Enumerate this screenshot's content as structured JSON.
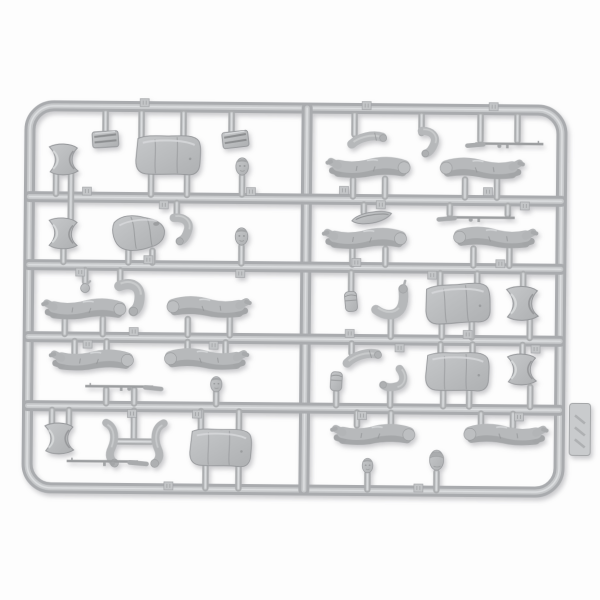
{
  "scene": {
    "type": "plastic-model-sprue-photo",
    "subject": "gray injection-molded sprue with soldier figure parts (torsos, legs, arms, heads, caps, rifles)",
    "rotation_deg": 0.5
  },
  "colors": {
    "background": "#fdfdfd",
    "rail_layers": [
      "#a9abae",
      "#c7c9cb",
      "#dcdee0"
    ],
    "stem_layers": [
      "#abadaf",
      "#c6c8ca",
      "#dadcde"
    ],
    "plastic_base": "#b6b8ba",
    "plastic_shadow": "#95979a",
    "plastic_highlight": "#d8dadc"
  },
  "sprue": {
    "frame": {
      "x1": 28.5,
      "y1": 108,
      "x2": 560.5,
      "y2": 490,
      "rx": 24
    },
    "center_rail_x": 305.5,
    "rails_y": [
      199,
      267,
      339,
      408
    ],
    "tab": {
      "x": 581,
      "y": 427
    }
  },
  "stems": [
    [
      104,
      114,
      134
    ],
    [
      140,
      114,
      140
    ],
    [
      182,
      114,
      140
    ],
    [
      230,
      114,
      133
    ],
    [
      55,
      176,
      196
    ],
    [
      70,
      176,
      223
    ],
    [
      150,
      175,
      196
    ],
    [
      186,
      175,
      196
    ],
    [
      241,
      177,
      195
    ],
    [
      63,
      250,
      264
    ],
    [
      128,
      252,
      264
    ],
    [
      152,
      252,
      264
    ],
    [
      176,
      204,
      219
    ],
    [
      241,
      247,
      264
    ],
    [
      85,
      272,
      284
    ],
    [
      120,
      272,
      286
    ],
    [
      65,
      322,
      336
    ],
    [
      103,
      320,
      336
    ],
    [
      188,
      320,
      336
    ],
    [
      230,
      317,
      336
    ],
    [
      75,
      343,
      355
    ],
    [
      107,
      343,
      357
    ],
    [
      188,
      343,
      353
    ],
    [
      226,
      343,
      353
    ],
    [
      107,
      391,
      405
    ],
    [
      135,
      391,
      405
    ],
    [
      217,
      393,
      405
    ],
    [
      53,
      412,
      428
    ],
    [
      70,
      412,
      428
    ],
    [
      135,
      412,
      440
    ],
    [
      202,
      412,
      433
    ],
    [
      240,
      412,
      433
    ],
    [
      207,
      466,
      489
    ],
    [
      240,
      466,
      489
    ],
    [
      353,
      114,
      134
    ],
    [
      420,
      114,
      132
    ],
    [
      479,
      114,
      139
    ],
    [
      516,
      114,
      139
    ],
    [
      352,
      179,
      196
    ],
    [
      384,
      178,
      196
    ],
    [
      464,
      178,
      196
    ],
    [
      496,
      178,
      196
    ],
    [
      363,
      204,
      212
    ],
    [
      449,
      204,
      213
    ],
    [
      507,
      204,
      213
    ],
    [
      352,
      249,
      264
    ],
    [
      385,
      248,
      264
    ],
    [
      473,
      247,
      264
    ],
    [
      509,
      247,
      264
    ],
    [
      351,
      272,
      291
    ],
    [
      391,
      317,
      336
    ],
    [
      440,
      272,
      286
    ],
    [
      477,
      272,
      286
    ],
    [
      442,
      321,
      336
    ],
    [
      472,
      321,
      336
    ],
    [
      523,
      272,
      288
    ],
    [
      530,
      318,
      336
    ],
    [
      352,
      343,
      353
    ],
    [
      337,
      392,
      405
    ],
    [
      391,
      390,
      405
    ],
    [
      441,
      343,
      354
    ],
    [
      473,
      343,
      354
    ],
    [
      444,
      390,
      405
    ],
    [
      470,
      390,
      405
    ],
    [
      523,
      343,
      352
    ],
    [
      531,
      385,
      405
    ],
    [
      358,
      412,
      425
    ],
    [
      392,
      412,
      427
    ],
    [
      482,
      412,
      425
    ],
    [
      514,
      412,
      425
    ],
    [
      369,
      473,
      489
    ],
    [
      438,
      471,
      489
    ]
  ],
  "hbars": [
    [
      118,
      152,
      443
    ]
  ],
  "tags": [
    [
      143,
      104
    ],
    [
      365,
      105
    ],
    [
      492,
      105
    ],
    [
      86,
      193
    ],
    [
      163,
      206
    ],
    [
      250,
      192
    ],
    [
      343,
      190
    ],
    [
      380,
      204
    ],
    [
      487,
      190
    ],
    [
      524,
      204
    ],
    [
      80,
      274
    ],
    [
      148,
      261
    ],
    [
      240,
      274
    ],
    [
      356,
      262
    ],
    [
      432,
      274
    ],
    [
      500,
      262
    ],
    [
      88,
      346
    ],
    [
      134,
      333
    ],
    [
      214,
      346
    ],
    [
      350,
      333
    ],
    [
      400,
      347
    ],
    [
      468,
      333
    ],
    [
      536,
      347
    ],
    [
      133,
      415
    ],
    [
      198,
      415
    ],
    [
      363,
      415
    ],
    [
      520,
      415
    ],
    [
      170,
      487
    ],
    [
      420,
      487
    ]
  ],
  "parts": [
    {
      "t": "folded",
      "x": 104,
      "y": 141,
      "r": -4,
      "f": 1,
      "s": 1
    },
    {
      "t": "torso",
      "x": 167,
      "y": 157,
      "r": 2,
      "f": 1,
      "s": 1
    },
    {
      "t": "folded",
      "x": 234,
      "y": 140,
      "r": -7,
      "f": 1,
      "s": 1
    },
    {
      "t": "skirt",
      "x": 63,
      "y": 162,
      "r": 0,
      "f": 1,
      "s": 1
    },
    {
      "t": "head",
      "x": 241,
      "y": 167,
      "r": 0,
      "f": 1,
      "s": 1
    },
    {
      "t": "skirt",
      "x": 63,
      "y": 236,
      "r": 2,
      "f": 1,
      "s": 1
    },
    {
      "t": "torso-bent",
      "x": 139,
      "y": 234,
      "r": -3,
      "f": 1,
      "s": 1
    },
    {
      "t": "arm-bent",
      "x": 180,
      "y": 228,
      "r": 15,
      "f": 1,
      "s": 1
    },
    {
      "t": "head",
      "x": 241,
      "y": 237,
      "r": 0,
      "f": 1,
      "s": 1
    },
    {
      "t": "hand",
      "x": 85,
      "y": 290,
      "r": 0,
      "f": 1,
      "s": 1
    },
    {
      "t": "arm-bent",
      "x": 130,
      "y": 296,
      "r": 0,
      "f": 1,
      "s": 1.2
    },
    {
      "t": "legs",
      "x": 85,
      "y": 312,
      "r": -2,
      "f": 1,
      "s": 1
    },
    {
      "t": "legs",
      "x": 208,
      "y": 309,
      "r": 2,
      "f": -1,
      "s": 1
    },
    {
      "t": "legs",
      "x": 93,
      "y": 363,
      "r": -2,
      "f": 1,
      "s": 1
    },
    {
      "t": "legs",
      "x": 206,
      "y": 361,
      "r": 2,
      "f": -1,
      "s": 1
    },
    {
      "t": "rifle",
      "x": 124,
      "y": 388,
      "r": 0,
      "f": 1,
      "s": 1
    },
    {
      "t": "head",
      "x": 217,
      "y": 385,
      "r": 0,
      "f": 1,
      "s": 0.9
    },
    {
      "t": "skirt",
      "x": 61,
      "y": 441,
      "r": 0,
      "f": 1,
      "s": 1
    },
    {
      "t": "arm-long",
      "x": 112,
      "y": 444,
      "r": -8,
      "f": 1,
      "s": 1
    },
    {
      "t": "arm-long",
      "x": 160,
      "y": 444,
      "r": 8,
      "f": -1,
      "s": 1
    },
    {
      "t": "rifle",
      "x": 108,
      "y": 463,
      "r": 0,
      "f": 1,
      "s": 1.05
    },
    {
      "t": "torso",
      "x": 222,
      "y": 449,
      "r": 3,
      "f": 1,
      "s": 0.95
    },
    {
      "t": "arm",
      "x": 366,
      "y": 140,
      "r": -6,
      "f": 1,
      "s": 1
    },
    {
      "t": "arm-bent",
      "x": 426,
      "y": 139,
      "r": 20,
      "f": 1,
      "s": 0.95
    },
    {
      "t": "rifle",
      "x": 504,
      "y": 142,
      "r": 0,
      "f": -1,
      "s": 1
    },
    {
      "t": "legs",
      "x": 368,
      "y": 168,
      "r": -2,
      "f": 1,
      "s": 1
    },
    {
      "t": "legs",
      "x": 480,
      "y": 168,
      "r": 2,
      "f": -1,
      "s": 1
    },
    {
      "t": "side-cap",
      "x": 371,
      "y": 217,
      "r": -4,
      "f": 1,
      "s": 1
    },
    {
      "t": "rifle",
      "x": 476,
      "y": 216,
      "r": 0,
      "f": -1,
      "s": 1
    },
    {
      "t": "legs",
      "x": 365,
      "y": 239,
      "r": -2,
      "f": 1,
      "s": 1
    },
    {
      "t": "legs",
      "x": 494,
      "y": 237,
      "r": 2,
      "f": -1,
      "s": 1
    },
    {
      "t": "pouch",
      "x": 351,
      "y": 301,
      "r": -5,
      "f": 1,
      "s": 1
    },
    {
      "t": "arm-bent-up",
      "x": 391,
      "y": 300,
      "r": 0,
      "f": 1,
      "s": 1
    },
    {
      "t": "torso",
      "x": 458,
      "y": 303,
      "r": -2,
      "f": 1,
      "s": 1
    },
    {
      "t": "skirt",
      "x": 523,
      "y": 302,
      "r": 0,
      "f": 1,
      "s": 1.1
    },
    {
      "t": "arm",
      "x": 363,
      "y": 358,
      "r": -10,
      "f": 1,
      "s": 1
    },
    {
      "t": "pouch",
      "x": 337,
      "y": 381,
      "r": 3,
      "f": 1,
      "s": 0.95
    },
    {
      "t": "arm-bent",
      "x": 396,
      "y": 378,
      "r": 75,
      "f": 1,
      "s": 0.95
    },
    {
      "t": "torso",
      "x": 458,
      "y": 371,
      "r": 2,
      "f": 1,
      "s": 0.98
    },
    {
      "t": "skirt",
      "x": 523,
      "y": 368,
      "r": 0,
      "f": 1,
      "s": 1
    },
    {
      "t": "legs",
      "x": 375,
      "y": 435,
      "r": -2,
      "f": 1,
      "s": 1
    },
    {
      "t": "legs",
      "x": 506,
      "y": 434,
      "r": 2,
      "f": -1,
      "s": 1
    },
    {
      "t": "head",
      "x": 369,
      "y": 465,
      "r": 0,
      "f": 1,
      "s": 0.85
    },
    {
      "t": "helmet-head",
      "x": 438,
      "y": 459,
      "r": 0,
      "f": 1,
      "s": 1
    }
  ]
}
